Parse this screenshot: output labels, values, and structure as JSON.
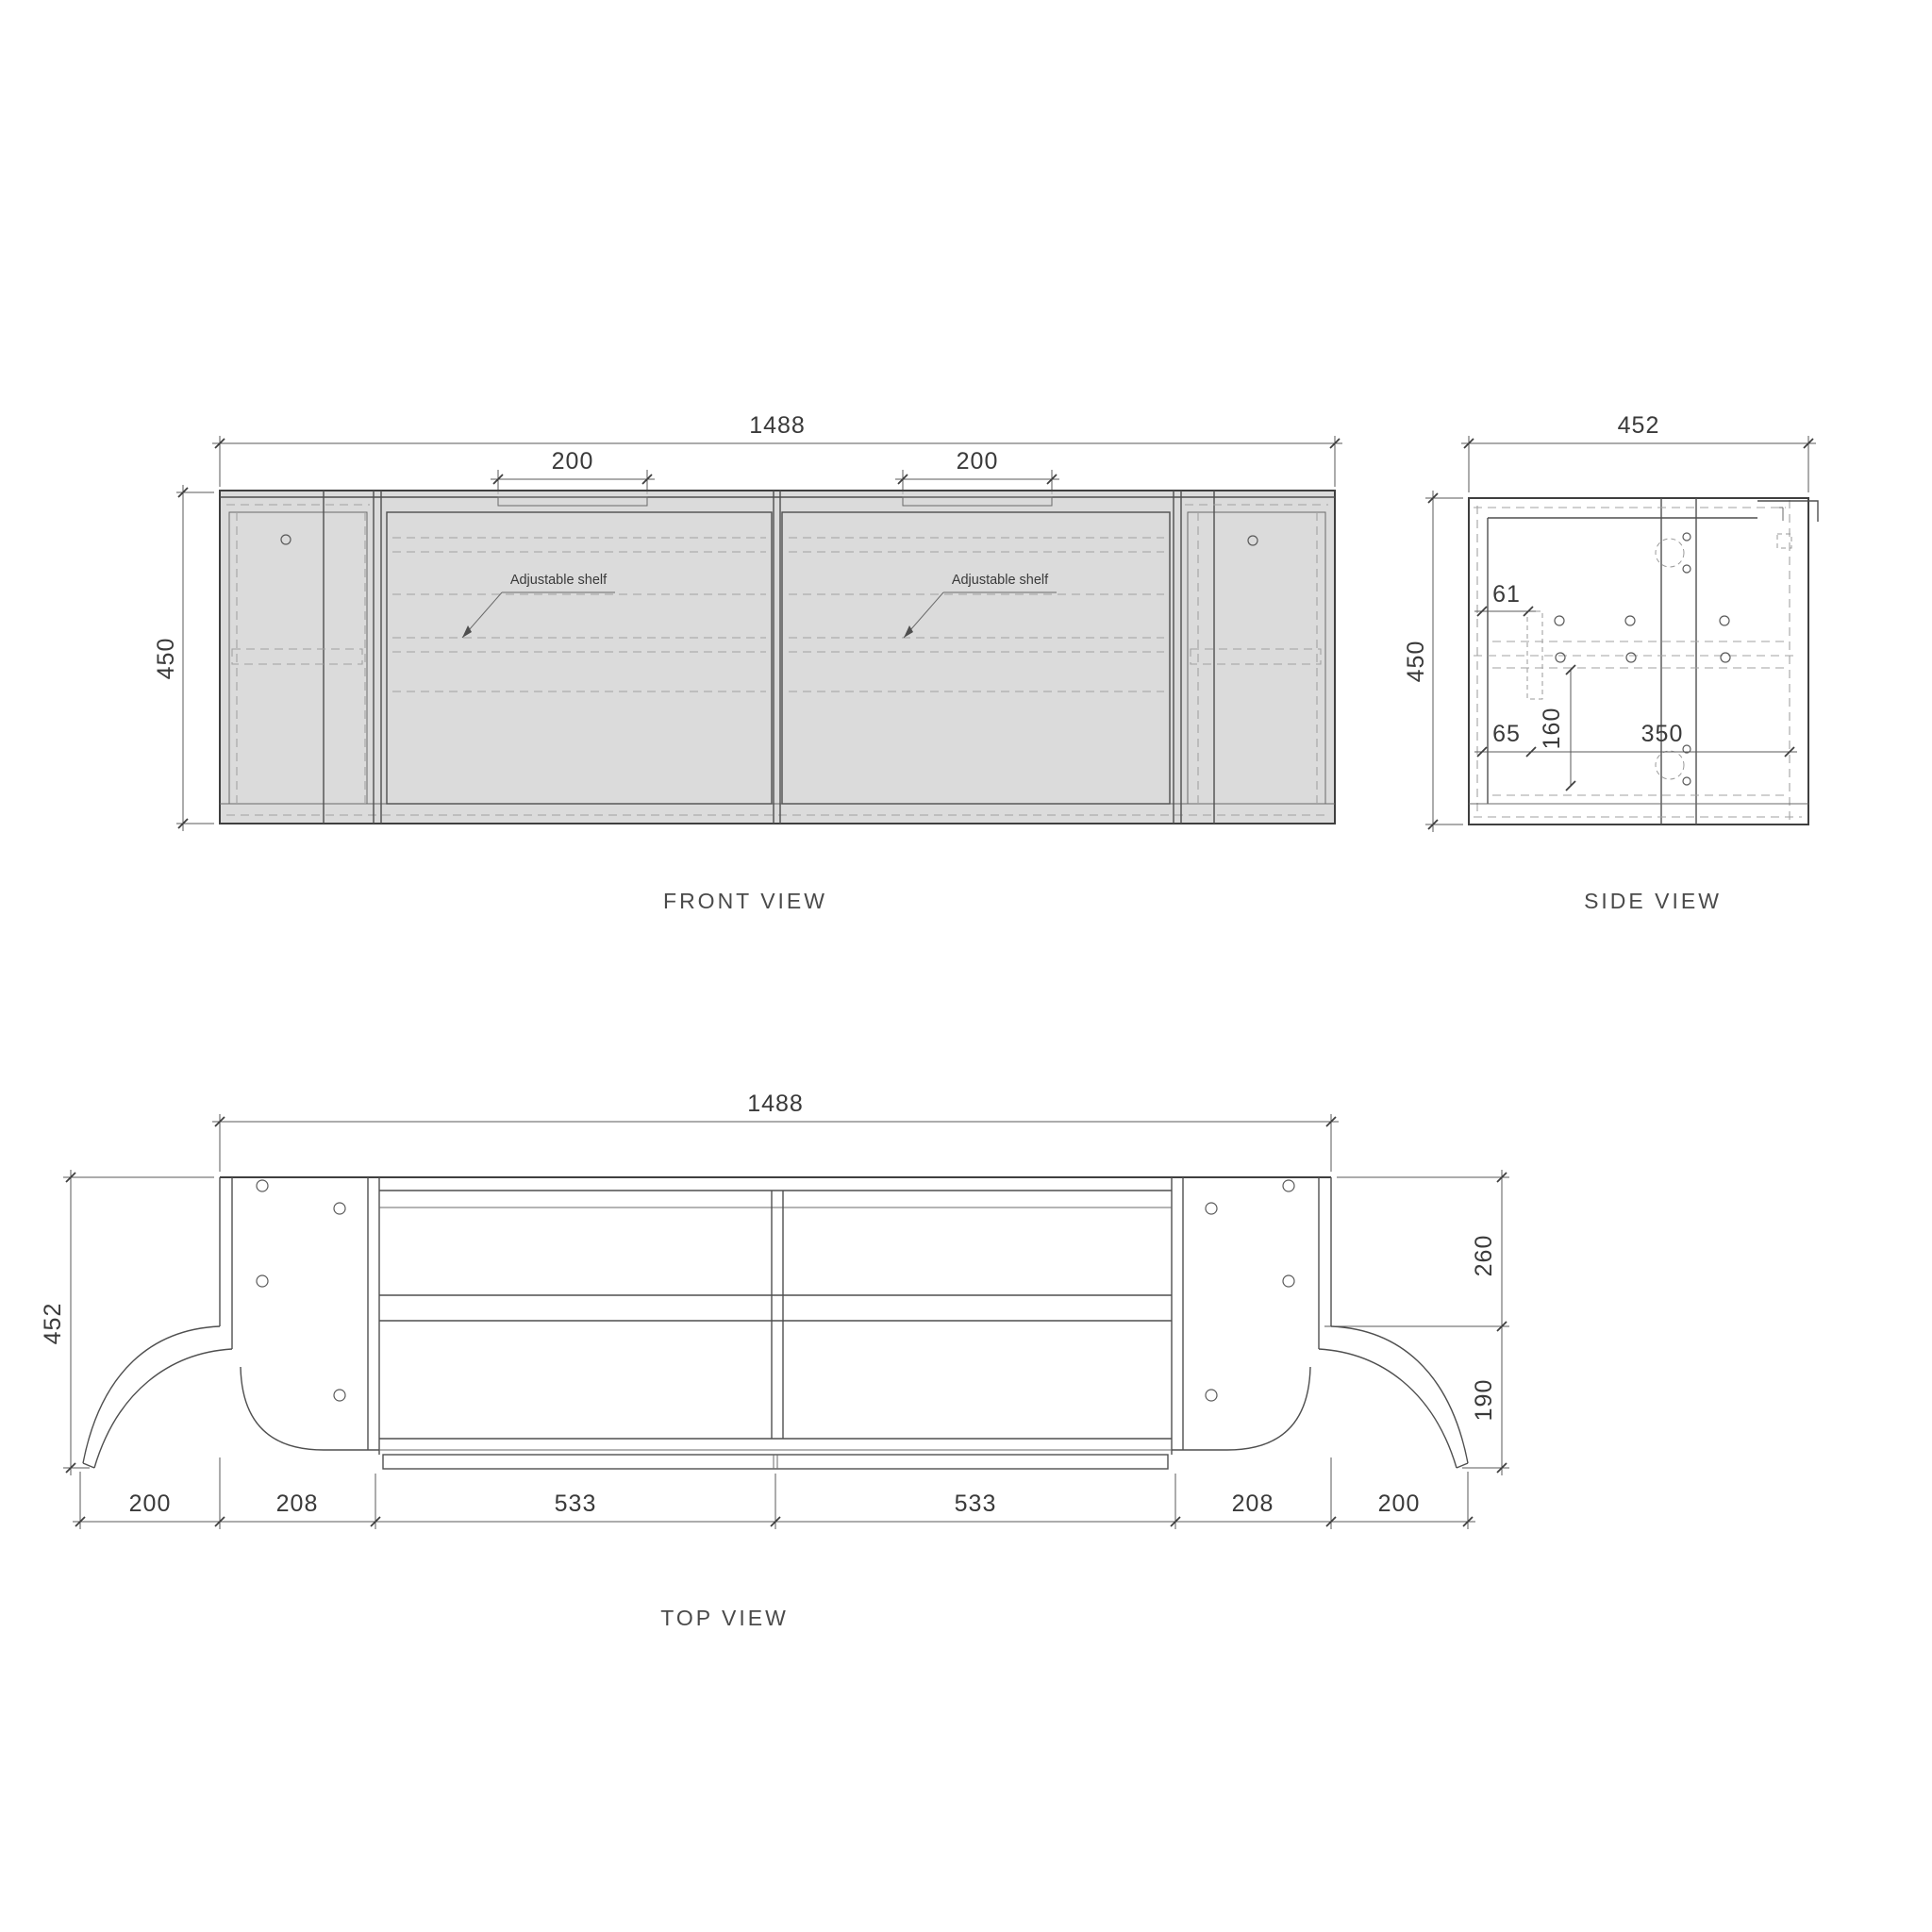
{
  "page": {
    "background": "#ffffff",
    "line_color": "#3f3f3f",
    "dash_color": "#a2a2a2",
    "text_color": "#3a3a3a"
  },
  "front_view": {
    "title": "FRONT VIEW",
    "width_dim": "1488",
    "height_dim": "450",
    "handle_dims": [
      "200",
      "200"
    ],
    "shelf_labels": [
      "Adjustable shelf",
      "Adjustable shelf"
    ]
  },
  "side_view": {
    "title": "SIDE VIEW",
    "width_dim": "452",
    "height_dim": "450",
    "top_offset_dim": "61",
    "bottom_offset_dim": "65",
    "vertical_dim": "160",
    "horizontal_dim": "350"
  },
  "top_view": {
    "title": "TOP VIEW",
    "width_dim": "1488",
    "depth_dim": "452",
    "back_depth_dim": "260",
    "front_depth_dim": "190",
    "bottom_dims": [
      "200",
      "208",
      "533",
      "533",
      "208",
      "200"
    ]
  }
}
